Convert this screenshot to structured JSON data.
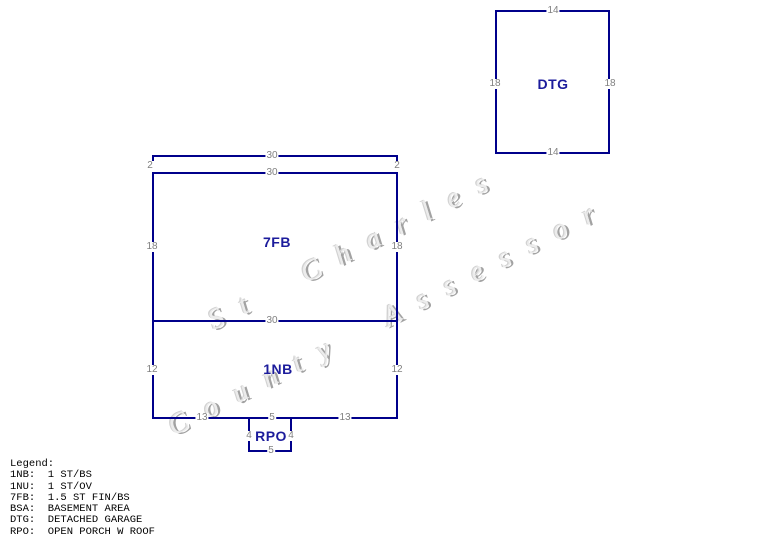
{
  "watermark": {
    "line1": "St Charles",
    "line2": "County Assessor"
  },
  "colors": {
    "sketch_line_navy": "#00008B",
    "building_label_navy": "#1C1C9C",
    "dimension_gray": "#808080",
    "legend_text_black": "#000000",
    "watermark_gray": "#c0c0c0",
    "background": "#ffffff"
  },
  "buildings": {
    "main": {
      "overhang": {
        "dim_width_top": "30",
        "dim_left": "2",
        "dim_right": "2",
        "dim_width_bottom": "30"
      },
      "fb": {
        "label": "7FB",
        "dim_left": "18",
        "dim_right": "18",
        "dim_bottom": "30"
      },
      "nb": {
        "label": "1NB",
        "dim_left": "12",
        "dim_right": "12",
        "dim_bottom_left": "13",
        "dim_bottom_center": "5",
        "dim_bottom_right": "13"
      }
    },
    "rpo": {
      "label": "RPO",
      "dim_left": "4",
      "dim_right": "4",
      "dim_bottom": "5"
    },
    "dtg": {
      "label": "DTG",
      "dim_top": "14",
      "dim_left": "18",
      "dim_right": "18",
      "dim_bottom": "14"
    }
  },
  "legend": {
    "title": "Legend:",
    "items": [
      "1NB:  1 ST/BS",
      "1NU:  1 ST/OV",
      "7FB:  1.5 ST FIN/BS",
      "BSA:  BASEMENT AREA",
      "DTG:  DETACHED GARAGE",
      "RPO:  OPEN PORCH W ROOF"
    ]
  }
}
